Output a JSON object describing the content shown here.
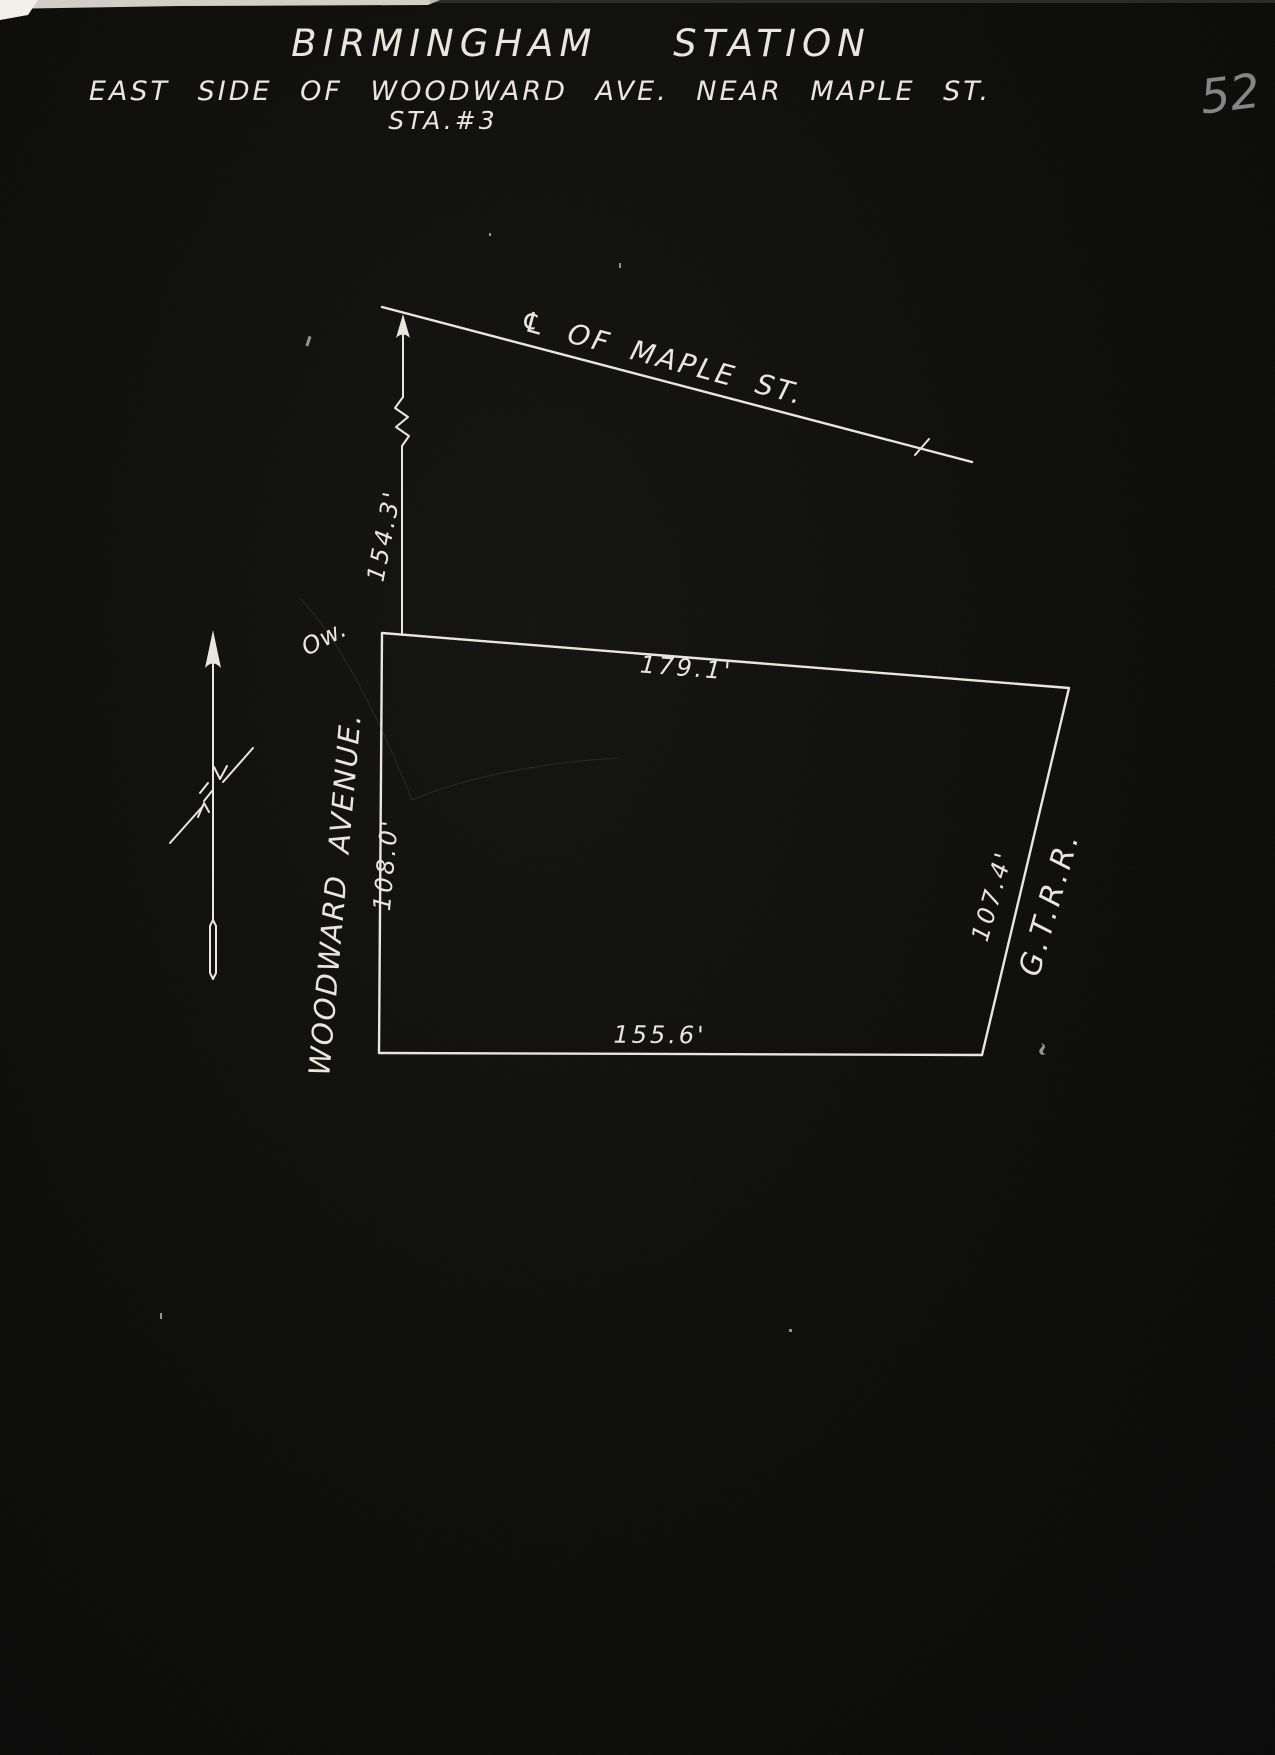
{
  "colors": {
    "background": "#0b0b0a",
    "ink": "#e9e6dd",
    "pencil": "#9a9a9a"
  },
  "page": {
    "number": "52"
  },
  "title": {
    "line1": "BIRMINGHAM STATION",
    "line2": "EAST SIDE OF WOODWARD AVE. NEAR MAPLE ST.",
    "line3": "STA.#3"
  },
  "diagram": {
    "maple_label": "℄ OF MAPLE ST.",
    "street_label": "WOODWARD AVENUE.",
    "railroad_label": "G.T.R.R.",
    "ow_label": "Ow.",
    "dimensions": {
      "maple_offset": "154.3'",
      "north_side": "179.1'",
      "west_side": "108.0'",
      "south_side": "155.6'",
      "east_side": "107.4'"
    }
  }
}
